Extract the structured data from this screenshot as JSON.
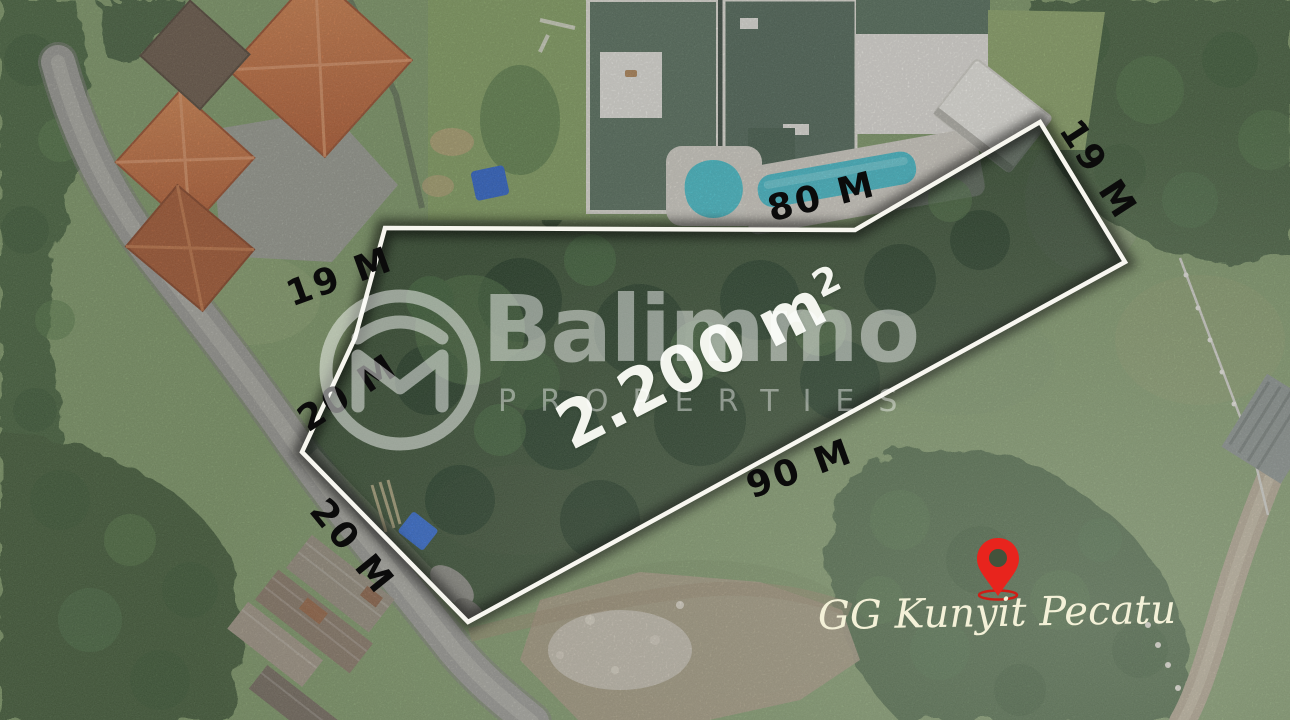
{
  "watermark": {
    "brand": "Balimmo",
    "tagline": "PROPERTIES"
  },
  "plot": {
    "area_value": "2.200 m",
    "area_superscript": "2",
    "dimensions": {
      "top": "80 M",
      "right": "19 M",
      "left_upper": "19 M",
      "left_lower": "20 M",
      "road_side": "20 M",
      "bottom": "90 M"
    }
  },
  "location": {
    "label": "GG Kunyit Pecatu"
  },
  "icons": {
    "pin": "location-pin",
    "logo": "balimmo-logo-mark"
  },
  "colors": {
    "plot_border": "#f7f6ef",
    "plot_overlay": "#16301c",
    "pin_red": "#e8241d",
    "pool": "#45c1ce",
    "roof_orange": "#c96b3f",
    "roof_green": "#57705d",
    "label_black": "#0b0b0b",
    "area_white": "#f3f5ee"
  }
}
